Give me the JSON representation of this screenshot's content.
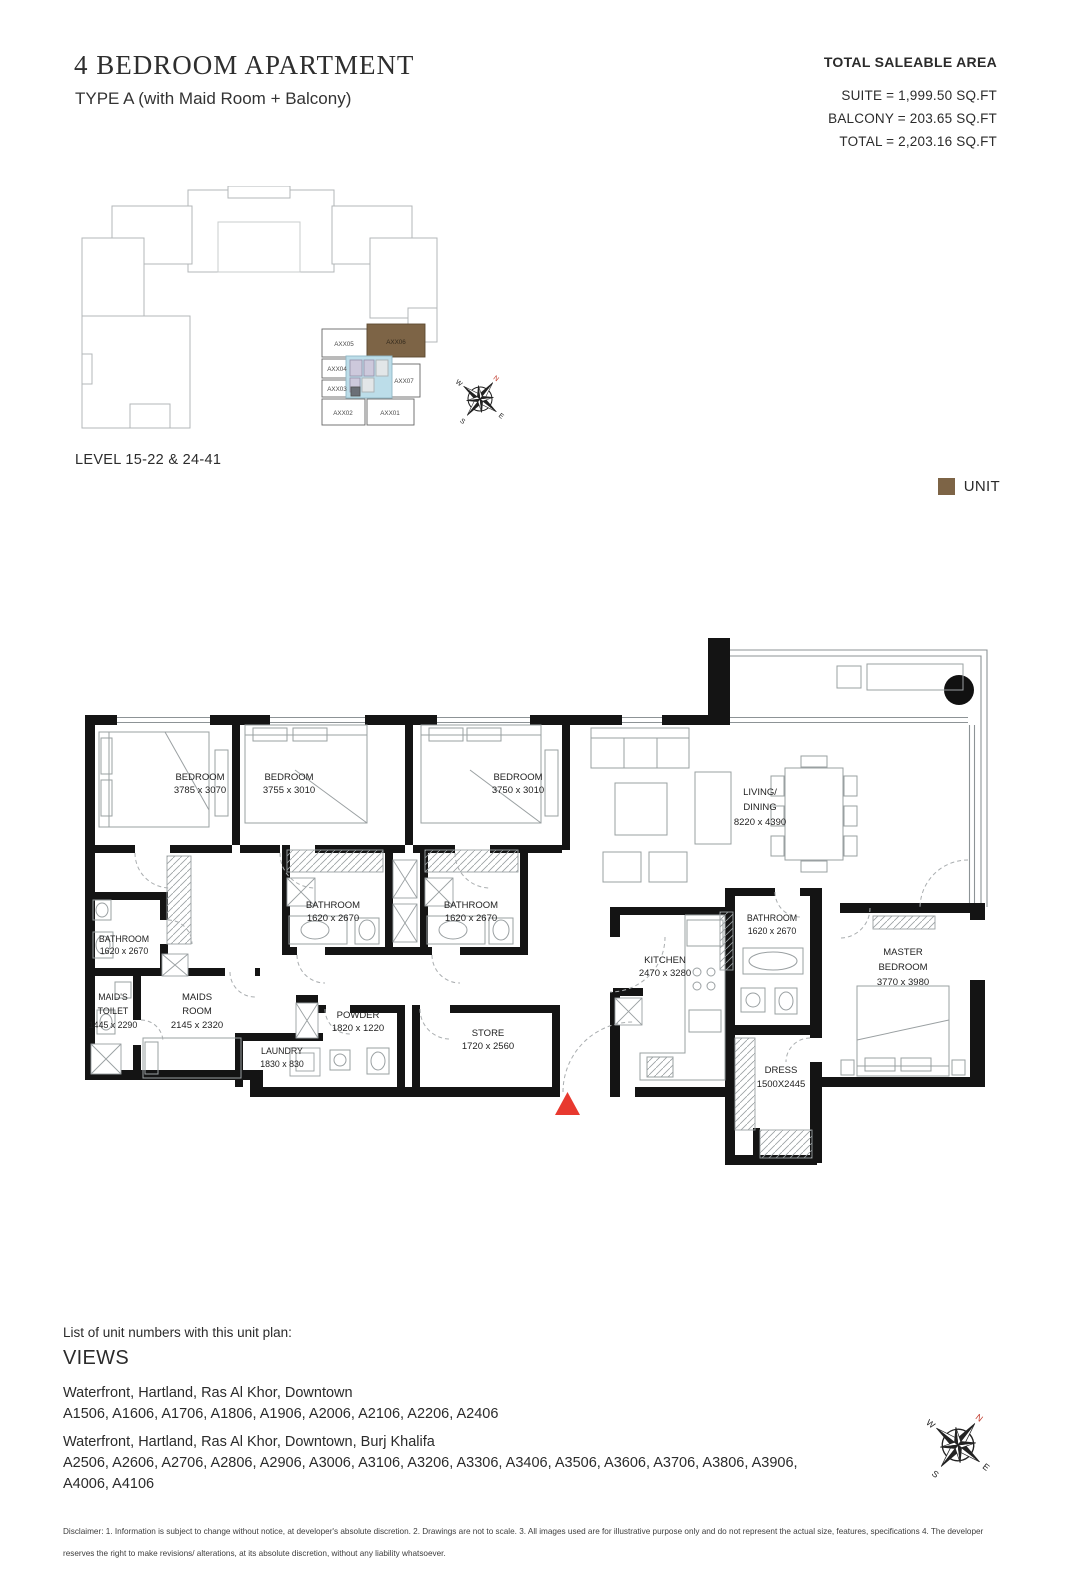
{
  "header": {
    "title": "4 BEDROOM APARTMENT",
    "subtitle": "TYPE A (with Maid Room + Balcony)"
  },
  "area_summary": {
    "heading": "TOTAL SALEABLE AREA",
    "lines": [
      "SUITE = 1,999.50 SQ.FT",
      "BALCONY = 203.65 SQ.FT",
      "TOTAL =  2,203.16 SQ.FT"
    ]
  },
  "key_plan": {
    "level_label": "LEVEL 15-22 & 24-41",
    "unit_labels": [
      "AXX05",
      "AXX06",
      "AXX04",
      "AXX03",
      "AXX07",
      "AXX02",
      "AXX01"
    ],
    "highlighted_unit": "AXX06",
    "legend_label": "UNIT",
    "unit_color": "#7d6446",
    "core_color": "#bcdde9"
  },
  "compass": {
    "n": "N",
    "e": "E",
    "s": "S",
    "w": "W"
  },
  "floor_plan": {
    "entry_marker_color": "#e8392f",
    "rooms": [
      {
        "id": "bedroom-1",
        "lines": [
          "BEDROOM",
          "3785 x 3070"
        ]
      },
      {
        "id": "bedroom-2",
        "lines": [
          "BEDROOM",
          "3755 x 3010"
        ]
      },
      {
        "id": "bedroom-3",
        "lines": [
          "BEDROOM",
          "3750 x 3010"
        ]
      },
      {
        "id": "living-dining",
        "lines": [
          "LIVING/",
          "DINING",
          "8220 x 4390"
        ]
      },
      {
        "id": "bathroom-mid-a",
        "lines": [
          "BATHROOM",
          "1620 x 2670"
        ]
      },
      {
        "id": "bathroom-mid-b",
        "lines": [
          "BATHROOM",
          "1620 x 2670"
        ]
      },
      {
        "id": "bathroom-left",
        "lines": [
          "BATHROOM",
          "1620 x 2670"
        ]
      },
      {
        "id": "maids-toilet",
        "lines": [
          "MAID'S",
          "TOILET",
          "1445 x 2290"
        ]
      },
      {
        "id": "maids-room",
        "lines": [
          "MAIDS",
          "ROOM",
          "2145 x 2320"
        ]
      },
      {
        "id": "laundry",
        "lines": [
          "LAUNDRY",
          "1830 x 830"
        ]
      },
      {
        "id": "powder",
        "lines": [
          "POWDER",
          "1820 x 1220"
        ]
      },
      {
        "id": "store",
        "lines": [
          "STORE",
          "1720 x 2560"
        ]
      },
      {
        "id": "kitchen",
        "lines": [
          "KITCHEN",
          "2470 x 3280"
        ]
      },
      {
        "id": "bathroom-master",
        "lines": [
          "BATHROOM",
          "1620 x 2670"
        ]
      },
      {
        "id": "master-bedroom",
        "lines": [
          "MASTER",
          "BEDROOM",
          "3770 x 3980"
        ]
      },
      {
        "id": "dress",
        "lines": [
          "DRESS",
          "1500X2445"
        ]
      }
    ]
  },
  "views_section": {
    "intro": "List of unit numbers with this unit plan:",
    "heading": "VIEWS",
    "groups": [
      {
        "views": "Waterfront, Hartland, Ras Al Khor, Downtown",
        "units": "A1506, A1606, A1706, A1806, A1906, A2006, A2106, A2206, A2406"
      },
      {
        "views": "Waterfront, Hartland, Ras Al Khor, Downtown, Burj Khalifa",
        "units": "A2506, A2606, A2706, A2806, A2906, A3006, A3106, A3206, A3306, A3406, A3506, A3606, A3706, A3806, A3906, A4006, A4106"
      }
    ]
  },
  "disclaimer": "Disclaimer: 1. Information is subject to change without notice, at developer's absolute discretion. 2. Drawings are not to scale. 3. All images used are for illustrative purpose only and do not represent the actual size, features, specifications 4. The developer reserves the right to make revisions/ alterations, at its absolute discretion, without any liability whatsoever."
}
